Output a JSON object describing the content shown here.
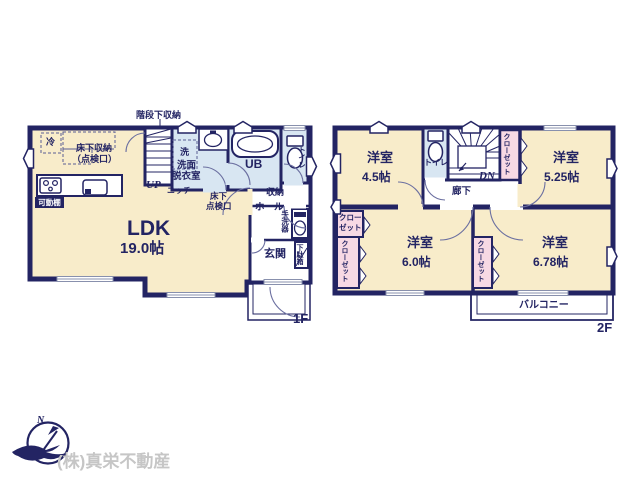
{
  "colors": {
    "wall_navy": "#232463",
    "room_cream": "#f8ecca",
    "wet_blue": "#d8e6f2",
    "closet_pink": "#f7d9e4",
    "window_gray": "#8890ad",
    "arc_gray": "#6b6fa0",
    "footer_gray": "#c6c6c6"
  },
  "floor1": {
    "floor_label": "1F",
    "ldk_name": "LDK",
    "ldk_size": "19.0帖",
    "stair_storage": "階段下収納",
    "fridge": "冷",
    "underfloor_storage": "床下収納",
    "underfloor_hatch": "（点検口）",
    "movable_shelf": "可動棚",
    "up": "UP",
    "niche": "ニッチ",
    "washer": "洗",
    "washroom_line1": "洗面",
    "washroom_line2": "脱衣室",
    "unit_bath": "UB",
    "toilet": "トイレ",
    "underfloor_line1": "床下",
    "underfloor_line2": "点検口",
    "storage": "収納",
    "hall": "ホール",
    "hand_basin": "手洗器",
    "entrance": "玄関",
    "shoe_cabinet": "下駄箱"
  },
  "floor2": {
    "floor_label": "2F",
    "rooms": [
      {
        "name": "洋室",
        "size": "4.5帖"
      },
      {
        "name": "洋室",
        "size": "5.25帖"
      },
      {
        "name": "洋室",
        "size": "6.0帖"
      },
      {
        "name": "洋室",
        "size": "6.78帖"
      }
    ],
    "toilet": "トイレ",
    "down": "DN",
    "closet": "クローゼット",
    "closet_line1": "クロー",
    "closet_line2": "ゼット",
    "corridor": "廊下",
    "balcony": "バルコニー"
  },
  "footer": {
    "company": "(株)真栄不動産",
    "compass_north": "N"
  }
}
